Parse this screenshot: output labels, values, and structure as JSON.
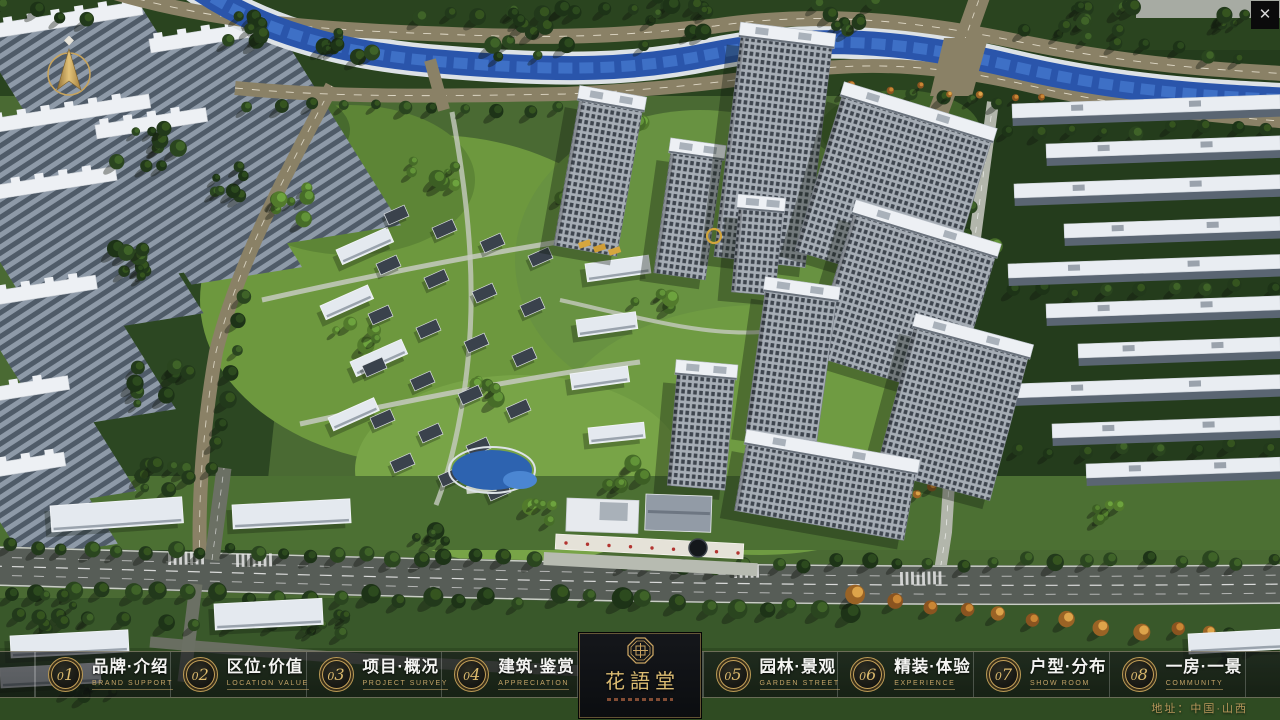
{
  "ui": {
    "close_glyph": "✕"
  },
  "logo": {
    "title": "花語堂"
  },
  "footer": {
    "address": "地址：中国·山西"
  },
  "nav": {
    "items": [
      {
        "id": "brand",
        "num": "01",
        "zh": "品牌·介绍",
        "en": "BRAND SUPPORT"
      },
      {
        "id": "location",
        "num": "02",
        "zh": "区位·价值",
        "en": "LOCATION VALUE"
      },
      {
        "id": "project",
        "num": "03",
        "zh": "项目·概况",
        "en": "PROJECT SURVEY"
      },
      {
        "id": "architecture",
        "num": "04",
        "zh": "建筑·鉴赏",
        "en": "APPRECIATION"
      },
      {
        "id": "garden",
        "num": "05",
        "zh": "园林·景观",
        "en": "GARDEN STREET"
      },
      {
        "id": "decoration",
        "num": "06",
        "zh": "精装·体验",
        "en": "EXPERIENCE"
      },
      {
        "id": "floorplan",
        "num": "07",
        "zh": "户型·分布",
        "en": "SHOW ROOM"
      },
      {
        "id": "view",
        "num": "08",
        "zh": "一房·一景",
        "en": "COMMUNITY"
      }
    ]
  },
  "scene": {
    "colors": {
      "river": "#2a55ab",
      "river_hi": "#4377cd",
      "bank": "#dde2e6",
      "road_tan": "#8a8166",
      "road_dark": "#575d57",
      "road_light": "#b2b6ab",
      "roof_white": "#edf0f4",
      "facade": "#a6adb5",
      "gold": "#d2a53b"
    },
    "blobs": [
      [
        "r",
        0,
        0,
        1280,
        96,
        0,
        "#2a441f",
        1
      ],
      [
        "r",
        952,
        50,
        328,
        500,
        0,
        "#243c1c",
        1
      ],
      [
        "r",
        108,
        88,
        200,
        480,
        6,
        "#2c4722",
        1
      ],
      [
        "e",
        430,
        300,
        230,
        165,
        0,
        "#6d983e",
        1
      ],
      [
        "e",
        700,
        260,
        185,
        150,
        0,
        "#689241",
        1
      ],
      [
        "e",
        760,
        430,
        205,
        125,
        0,
        "#6f9b42",
        1
      ],
      [
        "e",
        520,
        470,
        165,
        95,
        0,
        "#78a447",
        1
      ],
      [
        "e",
        350,
        180,
        125,
        75,
        0,
        "#5d8536",
        1
      ],
      [
        "r",
        0,
        476,
        1280,
        74,
        0,
        "#4c7033",
        1
      ],
      [
        "r",
        0,
        598,
        1280,
        122,
        0,
        "#39582a",
        1
      ],
      [
        "r",
        0,
        648,
        1280,
        72,
        0,
        "#2e4921",
        0.85
      ],
      [
        "r",
        1136,
        0,
        144,
        18,
        0,
        "#a7aba3",
        1
      ],
      [
        "e",
        260,
        130,
        90,
        45,
        0,
        "#476a2e",
        1
      ],
      [
        "e",
        900,
        130,
        80,
        40,
        0,
        "#3f6129",
        1
      ]
    ],
    "big_slabs": [
      [
        -24,
        34,
        168,
        250
      ],
      [
        150,
        46,
        128,
        235
      ],
      [
        -34,
        130,
        186,
        190
      ],
      [
        96,
        132,
        112,
        180
      ],
      [
        -40,
        198,
        158,
        165
      ],
      [
        -30,
        302,
        128,
        150
      ],
      [
        -42,
        400,
        112,
        128
      ],
      [
        -30,
        474,
        96,
        100
      ]
    ],
    "paths": [
      [
        "west-road",
        "M 332,86 C 288,170 238,262 216,352 C 202,432 198,502 200,566",
        "#8a8166",
        14,
        "",
        1
      ],
      [
        "west-road-dash",
        "M 332,86 C 288,170 238,262 216,352 C 202,432 198,502 200,566",
        "#e8e4d4",
        0.9,
        "7 8",
        0.8
      ],
      [
        "river-bank",
        "M 195,-14 C 255,28 335,54 445,62 C 565,72 635,70 712,54 C 812,34 902,40 1012,66 C 1122,92 1212,96 1292,100",
        "#dde2e6",
        33,
        "",
        1
      ],
      [
        "road-above-river",
        "M 88,-16 C 200,22 320,30 440,34 C 570,40 640,34 715,26 C 810,12 905,18 1020,42 C 1140,66 1220,70 1292,74",
        "#8a8166",
        15,
        "",
        1
      ],
      [
        "road-above-dash",
        "M 88,-16 C 200,22 320,30 440,34 C 570,40 640,34 715,26 C 810,12 905,18 1020,42 C 1140,66 1220,70 1292,74",
        "#efe9d8",
        0.9,
        "8 9",
        0.85
      ],
      [
        "road-below-river",
        "M 235,88 C 340,98 450,96 565,94 C 650,90 715,84 790,72 C 870,60 950,66 1040,88 C 1130,108 1215,116 1292,122",
        "#8a8166",
        14,
        "",
        1
      ],
      [
        "road-below-dash",
        "M 235,88 C 340,98 450,96 565,94 C 650,90 715,84 790,72 C 870,60 950,66 1040,88 C 1130,108 1215,116 1292,122",
        "#efe9d8",
        0.9,
        "8 9",
        0.85
      ],
      [
        "river-water",
        "M 195,-14 C 255,28 335,54 445,62 C 565,72 635,70 712,54 C 812,34 902,40 1012,66 C 1122,92 1212,96 1292,100",
        "#2a55ab",
        24,
        "",
        1
      ],
      [
        "river-hilite",
        "M 195,-14 C 255,28 335,54 445,62 C 565,72 635,70 712,54 C 812,34 902,40 1012,66 C 1122,92 1212,96 1292,100",
        "#4377cd",
        11,
        "14 7",
        0.8
      ],
      [
        "cross-road-tr",
        "M 983,-12 C 963,45 945,95 928,140 C 918,165 910,180 902,196",
        "#8a8166",
        20,
        "",
        1
      ],
      [
        "cross-road-tr-dash",
        "M 983,-12 C 963,45 945,95 928,140 C 918,165 910,180 902,196",
        "#efe9d8",
        0.9,
        "6 7",
        0.8
      ],
      [
        "north-bridge",
        "M 430,60 L 444,110",
        "#8a8166",
        12,
        "",
        1
      ],
      [
        "right-inner-road",
        "M 993,102 C 980,200 966,300 953,420 L 946,532 L 938,584",
        "#b2b6ab",
        12,
        "",
        1
      ],
      [
        "right-inner-dash",
        "M 993,102 C 980,200 966,300 953,420 L 946,532 L 938,584",
        "#ffffff",
        0.8,
        "6 8",
        0.7
      ],
      [
        "lane-1",
        "M 262,300 C 360,278 460,258 558,242",
        "#c6cabf",
        5,
        "",
        0.85
      ],
      [
        "lane-2",
        "M 300,424 C 410,400 520,378 640,362",
        "#c6cabf",
        5,
        "",
        0.85
      ],
      [
        "lane-3",
        "M 452,112 C 468,200 476,280 468,360 C 462,420 450,470 436,505",
        "#c6cabf",
        5,
        "",
        0.8
      ],
      [
        "lane-4",
        "M 560,300 C 640,318 704,336 762,332",
        "#c6cabf",
        4,
        "",
        0.8
      ],
      [
        "main-road",
        "M -10,566 C 300,574 700,590 1292,584",
        "#575d57",
        40,
        "",
        1
      ],
      [
        "main-edge-top",
        "M -10,547 C 300,555 700,571 1292,565",
        "#d6dad2",
        1.4,
        "",
        0.9
      ],
      [
        "main-edge-bot",
        "M -10,585 C 300,593 700,609 1292,603",
        "#d6dad2",
        1.4,
        "",
        0.9
      ],
      [
        "main-center",
        "M -10,566 C 300,574 700,590 1292,584",
        "#e8e8e8",
        1.2,
        "12 10",
        0.9
      ],
      [
        "main-lane-a",
        "M -10,557 C 300,565 700,581 1292,575",
        "#dcdcdc",
        1,
        "10 12",
        0.7
      ],
      [
        "main-lane-b",
        "M -10,575 C 300,583 700,599 1292,593",
        "#dcdcdc",
        1,
        "10 12",
        0.7
      ],
      [
        "service-road",
        "M 150,642 C 300,656 460,666 610,672",
        "#6b7064",
        11,
        "",
        0.95
      ],
      [
        "branch-up",
        "M 212,560 L 224,468",
        "#6b7064",
        15,
        "",
        1
      ],
      [
        "branch-up-dash",
        "M 212,560 L 224,468",
        "#e8e8e8",
        0.8,
        "6 7",
        0.7
      ],
      [
        "branch-down",
        "M 196,584 L 184,682",
        "#6b7064",
        13,
        "",
        1
      ]
    ],
    "polys": [
      [
        "944,38 988,38 972,96 930,96",
        "#8a8166",
        1
      ]
    ],
    "crosswalks": [
      [
        168,
        552,
        -1,
        7
      ],
      [
        236,
        554,
        -1,
        7
      ],
      [
        900,
        572,
        -1,
        8
      ],
      [
        734,
        565,
        -1,
        5
      ]
    ],
    "tree_rows": [
      [
        8,
        548,
        530,
        558,
        20,
        7,
        "d",
        3
      ],
      [
        620,
        566,
        1270,
        560,
        22,
        7,
        "d",
        4
      ],
      [
        10,
        592,
        520,
        600,
        18,
        8,
        "d",
        5
      ],
      [
        560,
        598,
        850,
        610,
        11,
        9,
        "d",
        6
      ],
      [
        860,
        598,
        1210,
        636,
        11,
        8,
        "o",
        7
      ],
      [
        250,
        106,
        560,
        110,
        11,
        6,
        "d",
        8
      ],
      [
        790,
        84,
        1030,
        106,
        9,
        6,
        "d",
        9
      ],
      [
        420,
        14,
        700,
        8,
        10,
        7,
        "d",
        10
      ],
      [
        1024,
        30,
        1240,
        58,
        8,
        6,
        "d",
        11
      ],
      [
        246,
        300,
        214,
        470,
        8,
        7,
        "d",
        12
      ],
      [
        976,
        140,
        954,
        396,
        9,
        6,
        "d",
        13
      ],
      [
        822,
        84,
        1046,
        96,
        8,
        4,
        "o",
        14
      ],
      [
        1010,
        132,
        1270,
        128,
        9,
        6,
        "d",
        15
      ],
      [
        1012,
        292,
        1270,
        288,
        9,
        6,
        "d",
        16
      ],
      [
        1016,
        452,
        1270,
        448,
        8,
        6,
        "d",
        17
      ],
      [
        20,
        614,
        340,
        630,
        10,
        7,
        "d",
        18
      ],
      [
        6,
        6,
        86,
        20,
        4,
        7,
        "d",
        19
      ]
    ],
    "tree_clusters": [
      [
        352,
        44,
        30,
        8,
        "d",
        21
      ],
      [
        252,
        24,
        38,
        9,
        "d",
        22
      ],
      [
        520,
        28,
        55,
        12,
        "d",
        23
      ],
      [
        666,
        22,
        46,
        10,
        "d",
        24
      ],
      [
        846,
        16,
        38,
        8,
        "d",
        25
      ],
      [
        1106,
        28,
        48,
        10,
        "d",
        26
      ],
      [
        1238,
        22,
        28,
        6,
        "d",
        27
      ],
      [
        150,
        152,
        44,
        10,
        "d",
        28
      ],
      [
        142,
        262,
        40,
        9,
        "d",
        29
      ],
      [
        152,
        382,
        40,
        9,
        "d",
        30
      ],
      [
        162,
        482,
        34,
        8,
        "d",
        31
      ],
      [
        234,
        182,
        28,
        7,
        "d",
        32
      ],
      [
        300,
        204,
        28,
        7,
        "l",
        33
      ],
      [
        436,
        172,
        32,
        7,
        "l",
        34
      ],
      [
        622,
        122,
        28,
        6,
        "l",
        35
      ],
      [
        560,
        204,
        22,
        5,
        "l",
        36
      ],
      [
        362,
        332,
        26,
        6,
        "l",
        37
      ],
      [
        482,
        392,
        22,
        6,
        "l",
        38
      ],
      [
        652,
        302,
        22,
        5,
        "l",
        39
      ],
      [
        702,
        402,
        22,
        5,
        "l",
        40
      ],
      [
        622,
        472,
        26,
        6,
        "l",
        41
      ],
      [
        542,
        512,
        22,
        5,
        "l",
        42
      ],
      [
        764,
        482,
        18,
        5,
        "l",
        43
      ],
      [
        864,
        302,
        18,
        5,
        "l",
        44
      ],
      [
        980,
        244,
        16,
        4,
        "l",
        45
      ],
      [
        60,
        612,
        32,
        8,
        "d",
        46
      ],
      [
        92,
        690,
        28,
        6,
        "d",
        47
      ],
      [
        334,
        628,
        26,
        6,
        "d",
        48
      ],
      [
        1244,
        646,
        26,
        6,
        "d",
        49
      ],
      [
        906,
        478,
        30,
        7,
        "o",
        50
      ],
      [
        1100,
        512,
        22,
        5,
        "l",
        51
      ],
      [
        430,
        540,
        20,
        5,
        "d",
        52
      ]
    ],
    "right_rows": [
      [
        1012,
        104,
        268
      ],
      [
        1046,
        144,
        234
      ],
      [
        1014,
        184,
        266
      ],
      [
        1064,
        224,
        216
      ],
      [
        1008,
        264,
        272
      ],
      [
        1046,
        304,
        234
      ],
      [
        1078,
        344,
        202
      ],
      [
        1012,
        384,
        268
      ],
      [
        1052,
        424,
        228
      ],
      [
        1086,
        464,
        194
      ]
    ],
    "slabs": [
      [
        50,
        506,
        132,
        26,
        -4
      ],
      [
        232,
        505,
        118,
        24,
        -3
      ],
      [
        214,
        604,
        108,
        26,
        -3
      ],
      [
        10,
        636,
        118,
        22,
        -3
      ],
      [
        0,
        668,
        100,
        20,
        -3
      ],
      [
        336,
        250,
        56,
        16,
        -24
      ],
      [
        320,
        306,
        52,
        15,
        -24
      ],
      [
        350,
        362,
        56,
        16,
        -24
      ],
      [
        328,
        418,
        50,
        14,
        -24
      ],
      [
        585,
        264,
        64,
        18,
        -8
      ],
      [
        576,
        320,
        60,
        17,
        -8
      ],
      [
        570,
        374,
        58,
        16,
        -8
      ],
      [
        588,
        428,
        56,
        16,
        -6
      ],
      [
        1188,
        634,
        96,
        20,
        -3
      ]
    ],
    "villa_rows": [
      [
        384,
        214,
        4,
        48,
        14
      ],
      [
        376,
        264,
        4,
        48,
        14
      ],
      [
        368,
        314,
        4,
        48,
        14
      ],
      [
        362,
        366,
        4,
        48,
        14
      ],
      [
        370,
        418,
        3,
        48,
        14
      ],
      [
        390,
        462,
        3,
        48,
        14
      ]
    ],
    "towers": [
      [
        598,
        178,
        64,
        148,
        10
      ],
      [
        688,
        216,
        52,
        122,
        8
      ],
      [
        773,
        152,
        92,
        222,
        7
      ],
      [
        893,
        196,
        156,
        162,
        17
      ],
      [
        903,
        306,
        148,
        148,
        17
      ],
      [
        952,
        414,
        118,
        148,
        15
      ],
      [
        757,
        252,
        44,
        84,
        5
      ],
      [
        791,
        366,
        72,
        142,
        8
      ],
      [
        701,
        432,
        58,
        112,
        5
      ],
      [
        825,
        492,
        172,
        68,
        10
      ]
    ],
    "entrance_rects": [
      [
        567,
        498,
        72,
        33,
        2,
        "#e7eaee",
        "#c9ced4"
      ],
      [
        600,
        502,
        28,
        18,
        2,
        "#a9b1b9",
        ""
      ],
      [
        646,
        494,
        66,
        36,
        2,
        "#929ba6",
        "#e8ebee"
      ],
      [
        648,
        510,
        62,
        3,
        2,
        "#6d7682",
        ""
      ],
      [
        556,
        534,
        188,
        15,
        3,
        "#e5e2d8",
        "#f6f4ee"
      ],
      [
        544,
        552,
        214,
        13,
        3,
        "#b7bbb1",
        ""
      ],
      [
        466,
        486,
        30,
        8,
        -6,
        "#ccd2c6",
        ""
      ]
    ],
    "pond": {
      "body": [
        492,
        470,
        40,
        20,
        "#2d63b0"
      ],
      "hilite": [
        520,
        480,
        17,
        9,
        "#4b86d2"
      ],
      "rim": [
        492,
        470,
        43,
        23,
        "#dde3e7"
      ]
    },
    "red_dot_row": [
      566,
      543,
      738,
      553,
      9,
      1.7,
      "#b23430"
    ],
    "gold_ring": [
      714,
      236,
      7
    ],
    "gold_rects": [
      [
        578,
        243,
        12,
        6,
        -18,
        "#d6a63e"
      ],
      [
        593,
        247,
        12,
        6,
        -18,
        "#cf9d36"
      ],
      [
        608,
        250,
        12,
        6,
        -18,
        "#d6a63e"
      ]
    ],
    "emblem_circle": [
      698,
      548,
      9,
      "#14171b",
      "#3c424a"
    ]
  }
}
